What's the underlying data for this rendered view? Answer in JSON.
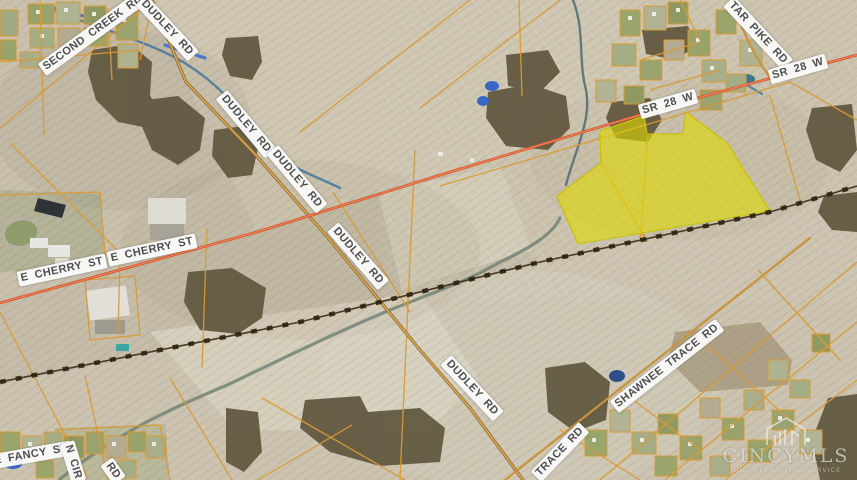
{
  "map": {
    "type": "aerial-parcel-map",
    "road_labels": [
      {
        "id": "second-creek-rd",
        "text": "SECOND CREEK RD"
      },
      {
        "id": "dudley-rd-top",
        "text": "DUDLEY RD"
      },
      {
        "id": "dudley-rd-2",
        "text": "DUDLEY RD"
      },
      {
        "id": "dudley-rd-3",
        "text": "DUDLEY RD"
      },
      {
        "id": "dudley-rd-4",
        "text": "DUDLEY RD"
      },
      {
        "id": "dudley-rd-5",
        "text": "DUDLEY RD"
      },
      {
        "id": "tar-pike-rd",
        "text": "TAR PIKE RD"
      },
      {
        "id": "sr-28-w-1",
        "text": "SR 28 W"
      },
      {
        "id": "sr-28-w-2",
        "text": "SR 28 W"
      },
      {
        "id": "e-cherry-st-1",
        "text": "E CHERRY ST"
      },
      {
        "id": "e-cherry-st-2",
        "text": "E CHERRY ST"
      },
      {
        "id": "shawnee-trace-rd",
        "text": "SHAWNEE TRACE RD"
      },
      {
        "id": "trace-rd-partial",
        "text": "TRACE RD"
      },
      {
        "id": "e-fancy-st",
        "text": "E FANCY ST"
      },
      {
        "id": "n-cir-partial",
        "text": "N CIR"
      },
      {
        "id": "rd-partial",
        "text": "RD"
      }
    ],
    "watermark": {
      "title": "CINCYMLS",
      "tagline": "MULTIPLE LISTING SERVICE",
      "logo_icon": "cincymls-house-logo-icon"
    },
    "highlighted_parcel": {
      "fill_color": "#e0da00"
    },
    "colors": {
      "background": "#c9c1ad",
      "parcel_line": "#d89a35",
      "highway": "#d4572f",
      "railroad": "#2c2212",
      "water": "#4a7a9c",
      "highlight": "#dcd800"
    }
  }
}
